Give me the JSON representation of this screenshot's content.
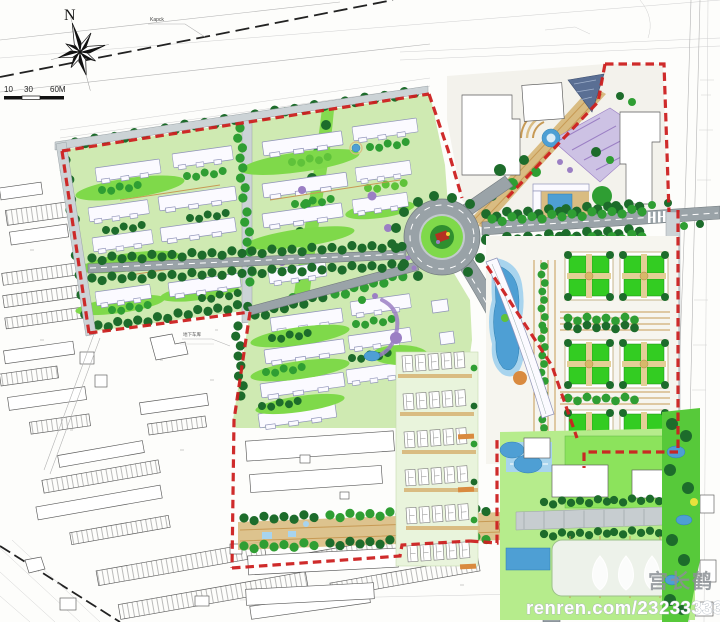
{
  "compass": {
    "north_label": "N"
  },
  "scale_bar": {
    "tick_labels": [
      "10",
      "30",
      "60M"
    ]
  },
  "survey": {
    "road_label": "Kapck"
  },
  "site_labels": {
    "garage_note": "地下车库"
  },
  "watermark": {
    "artist_name": "宫长鹤",
    "site_text": "renren.com/2323333316",
    "logo": "tulip-logo"
  },
  "palette": {
    "red": "#cc2020",
    "road": "#9aa3a8",
    "roadlight": "#ccd3d6",
    "treedark": "#1d6c2b",
    "treemid": "#2f9e33",
    "treelight": "#5fc23a",
    "lawn": "#7fd94a",
    "lawnpale": "#cfeab2",
    "water": "#4e9fd4",
    "waterlight": "#a8d4ee",
    "tan": "#d9bc82",
    "tanline": "#c79a55",
    "purple": "#9b7fc4",
    "slabfill": "#fbfaff",
    "slabstroke": "#8f93b8",
    "plaza": "#9ce465",
    "parkgreen": "#4fc437",
    "watermarkgray": "#8b9095"
  }
}
